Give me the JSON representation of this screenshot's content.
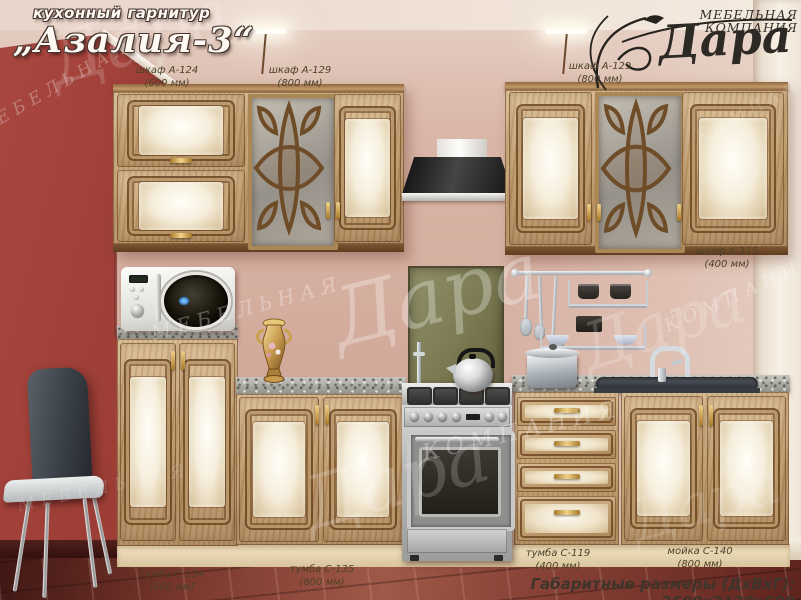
{
  "title": {
    "category": "кухонный гарнитур",
    "name": "„Азалия-3“"
  },
  "brand": {
    "type": "МЕБЕЛЬНАЯ КОМПАНИЯ",
    "name": "Дара"
  },
  "callouts": [
    {
      "name": "шкаф А-124",
      "size": "(600 мм)"
    },
    {
      "name": "шкаф А-129",
      "size": "(800 мм)"
    },
    {
      "name": "шкаф А-129",
      "size": "(800 мм)"
    },
    {
      "name": "шкаф А-115",
      "size": "(400 мм)"
    },
    {
      "name": "тумба С-134",
      "size": "(600 мм)"
    },
    {
      "name": "тумба С-135",
      "size": "(800 мм)"
    },
    {
      "name": "тумба С-119",
      "size": "(400 мм)"
    },
    {
      "name": "мойка С-140",
      "size": "(800 мм)"
    }
  ],
  "footer": {
    "dimensions": "Габаритные размеры (ДхВхГ): 2600х2120х600"
  },
  "watermark": {
    "script": "Дара",
    "word1": "МЕБЕЛЬНАЯ",
    "word2": "КОМПАНИЯ"
  },
  "colors": {
    "red_wall": "#93372f",
    "pink_wall": "#d7b3a5",
    "wood_frame": "#7a5230",
    "panel_cream": "#f6eedc",
    "gold_handle": "#c9a050",
    "olive_backsplash": "#7b7a52",
    "hood_black": "#1a1a1a",
    "floor_maroon": "#6b2e26"
  }
}
